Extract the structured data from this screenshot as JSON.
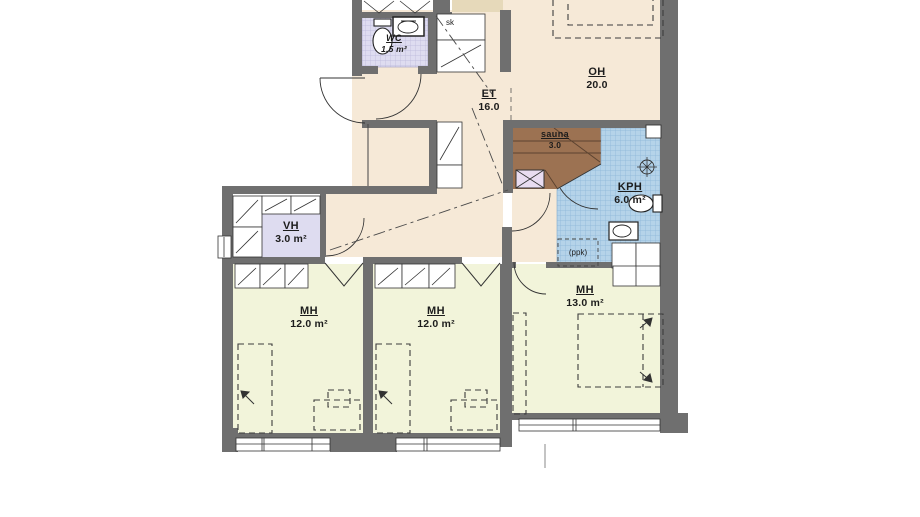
{
  "title": "Apartment floor plan (3 bedrooms + sauna)",
  "rooms": {
    "wc": {
      "name": "WC",
      "area": "1.5 m²"
    },
    "sk": {
      "name": "sk"
    },
    "et": {
      "name": "ET",
      "area": "16.0"
    },
    "oh": {
      "name": "OH",
      "area": "20.0"
    },
    "sauna": {
      "name": "sauna",
      "area": "3.0"
    },
    "kph": {
      "name": "KPH",
      "area": "6.0 m²"
    },
    "ppk": {
      "name": "(ppk)"
    },
    "vh": {
      "name": "VH",
      "area": "3.0 m²"
    },
    "mh1": {
      "name": "MH",
      "area": "12.0 m²"
    },
    "mh2": {
      "name": "MH",
      "area": "12.0 m²"
    },
    "mh3": {
      "name": "MH",
      "area": "13.0 m²"
    }
  },
  "colors": {
    "wall_gray": "#6f6f6f",
    "floor_hall_living": "#f6e9d7",
    "floor_bedroom": "#f2f4da",
    "floor_closet_lavender": "#dedcf0",
    "floor_bathroom_blue": "#b5d3e9",
    "bathroom_tile_grid": "#8ab5d8",
    "floor_sauna_wood": "#9c7252",
    "top_block_tan": "#e6d9ba",
    "line_dark": "#333333"
  }
}
